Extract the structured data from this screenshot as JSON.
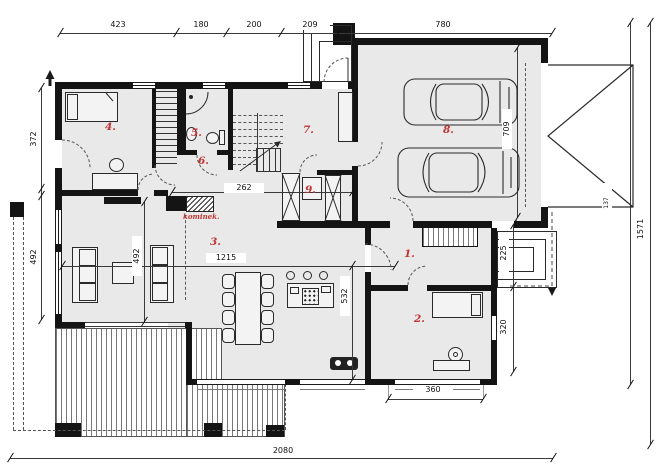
{
  "dims": {
    "top": [
      "423",
      "180",
      "200",
      "209",
      "780"
    ],
    "bottom": "2080",
    "left": [
      "372",
      "492"
    ],
    "right": "1571",
    "interior": {
      "hall": "262",
      "living_width": "1215",
      "living_depth": "492",
      "kitchen_depth": "532",
      "garage_depth": "709",
      "side_entry": "225",
      "room2_depth": "320",
      "room2_window": "360",
      "gate_leaf": "137"
    }
  },
  "rooms": {
    "n1": "1.",
    "n2": "2.",
    "n3": "3.",
    "n4": "4.",
    "n5": "5.",
    "n6": "6.",
    "n7": "7.",
    "n8": "8.",
    "n9": "9."
  },
  "labels": {
    "fireplace": "kominek."
  },
  "colors": {
    "wall": "#141414",
    "floor": "#e9e9e9",
    "room_number": "#c23432",
    "dimension_text": "#111111"
  }
}
